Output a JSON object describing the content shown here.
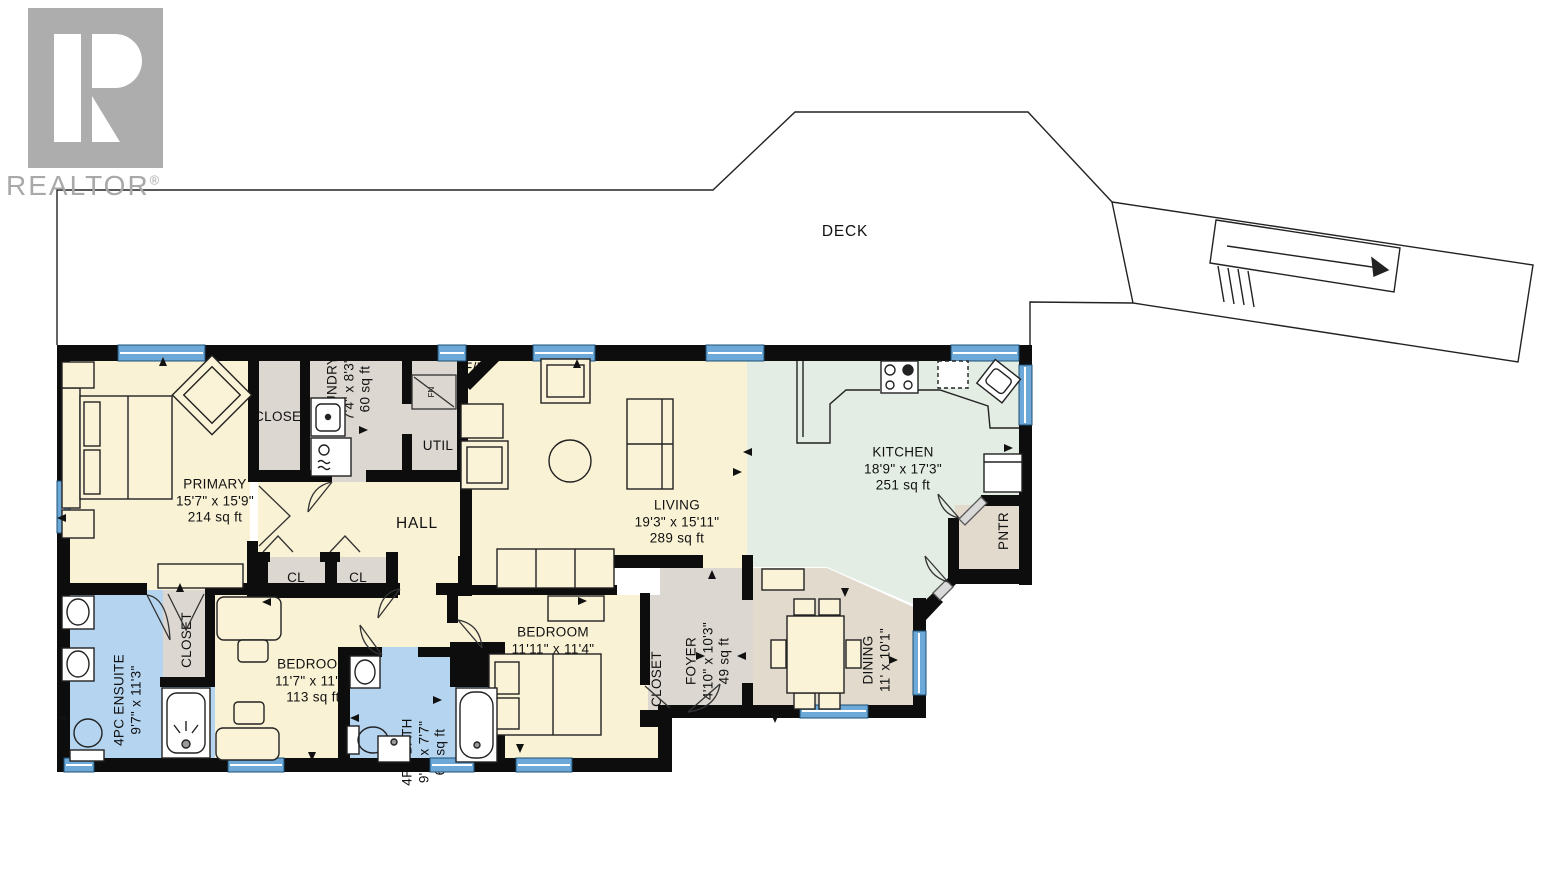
{
  "branding": {
    "name": "REALTOR",
    "registered": "®"
  },
  "colors": {
    "wall": "#0d0d0d",
    "floor_cream": "#faf2d5",
    "floor_gray": "#dcd7d0",
    "floor_green": "#e3ede4",
    "floor_tan": "#e2dacc",
    "floor_blue": "#b4d4ef",
    "window_blue": "#6ca9d8",
    "logo_gray": "#adadad"
  },
  "rooms": {
    "deck": {
      "label": "DECK"
    },
    "primary": {
      "label": "PRIMARY",
      "dims": "15'7\" x 15'9\"",
      "area": "214 sq ft"
    },
    "primary_closet": {
      "label": "CLOSET"
    },
    "laundry": {
      "label": "LAUNDRY",
      "dims": "7'4\" x 8'3\"",
      "area": "60 sq ft"
    },
    "util": {
      "label": "UTIL"
    },
    "fireplace": {
      "label": "F/P"
    },
    "furnace": {
      "label": "FN"
    },
    "hall": {
      "label": "HALL"
    },
    "cl1": {
      "label": "CL"
    },
    "cl2": {
      "label": "CL"
    },
    "living": {
      "label": "LIVING",
      "dims": "19'3\" x 15'11\"",
      "area": "289 sq ft"
    },
    "kitchen": {
      "label": "KITCHEN",
      "dims": "18'9\" x 17'3\"",
      "area": "251 sq ft"
    },
    "pantry": {
      "label": "PNTR"
    },
    "foyer": {
      "label": "FOYER",
      "dims": "4'10\" x 10'3\"",
      "area": "49 sq ft"
    },
    "dining": {
      "label": "DINING",
      "dims": "11' x 10'1\""
    },
    "bedroom2": {
      "label": "BEDROOM",
      "dims": "11'11\" x 11'4\""
    },
    "bedroom2_closet": {
      "label": "CLOSET"
    },
    "bedroom1": {
      "label": "BEDROOM",
      "dims": "11'7\" x 11'4\"",
      "area": "113 sq ft"
    },
    "bedroom1_closet": {
      "label": "CLOSET"
    },
    "ensuite": {
      "label": "4PC ENSUITE",
      "dims": "9'7\" x 11'3\""
    },
    "bath": {
      "label": "4PC BATH",
      "dims": "9'8\" x 7'7\"",
      "area": "61 sq ft"
    }
  }
}
